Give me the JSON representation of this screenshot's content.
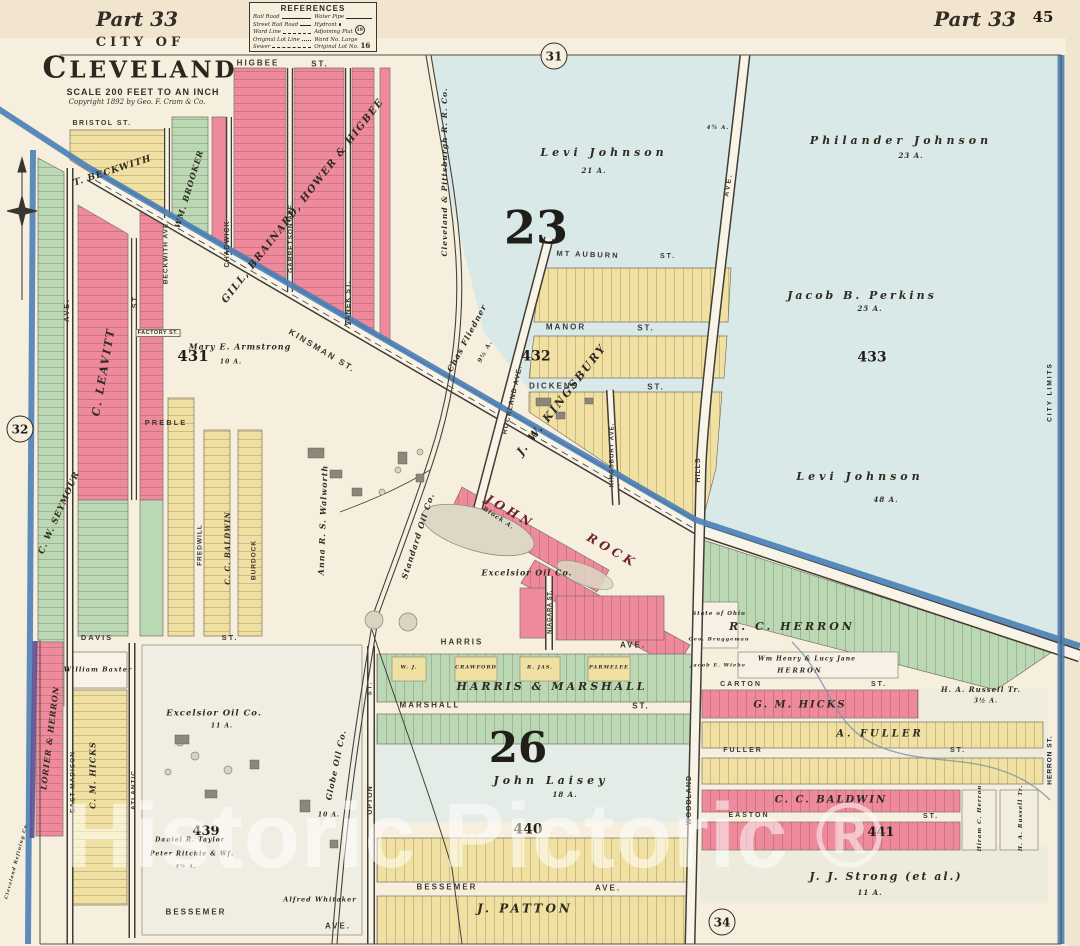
{
  "header": {
    "part_left": "Part 33",
    "city_of": "CITY OF",
    "cleveland": "CLEVELAND",
    "scale": "SCALE 200 FEET TO AN INCH",
    "copyright": "Copyright 1892 by Geo. F. Cram & Co.",
    "part_right": "Part 33",
    "page_number": "45",
    "watermark": "Historic Pictoric ®"
  },
  "references": {
    "title": "REFERENCES",
    "rail_road": "Rail Road",
    "street_rail_road": "Street Rail Road",
    "ward_line": "Ward Line",
    "original_lot_line": "Original Lot Line",
    "sewer": "Sewer",
    "water_pipe": "Water Pipe",
    "hydrant": "Hydrant",
    "adjoining_plat": "Adjoining Plat",
    "adjoining_plat_no": "19",
    "ward_no": "Ward No. Large",
    "original_lot_no": "Original Lot No.",
    "original_lot_no_val": "16"
  },
  "circles": {
    "plate_31": "31",
    "plate_32": "32",
    "plate_34": "34"
  },
  "wards": {
    "ward_23": "23",
    "ward_26": "26"
  },
  "blocks": {
    "b431": "431",
    "b432": "432",
    "b433": "433",
    "b439": "439",
    "b440": "440",
    "b441": "441"
  },
  "streets": {
    "bristol": "BRISTOL ST.",
    "higbee": "HIGBEE",
    "higbee_st": "ST.",
    "beckwith_ave": "BECKWITH AVE.",
    "chadwick": "CHADWICK",
    "garretson": "GARRETSON AVE.",
    "vanek": "VANEK ST.",
    "kinsman": "KINSMAN ST.",
    "factory": "FACTORY ST.",
    "ave_left": "AVE.",
    "st_left": "ST.",
    "preble": "PREBLE",
    "fredwill": "FREDWILL",
    "burdock": "BURDOCK",
    "davis": "DAVIS",
    "davis_st": "ST.",
    "east_madison": "EAST MADISON",
    "atlantic": "ATLANTIC",
    "upton": "UPTON",
    "upton_st": "ST.",
    "mt_auburn": "MT AUBURN",
    "mt_auburn_st": "ST.",
    "manor": "MANOR",
    "manor_st": "ST.",
    "dickens": "DICKENS",
    "dickens_st": "ST.",
    "rockland": "ROCKLAND AVE.",
    "kingsbury": "KINGSBURY AVE.",
    "niagara": "NIAGARA ST.",
    "harris": "HARRIS",
    "harris_ave": "AVE.",
    "marshall": "MARSHALL",
    "marshall_st": "ST.",
    "bessemer_mid": "BESSEMER",
    "bessemer_mid_ave": "AVE.",
    "bessemer_left": "BESSEMER",
    "bessemer_left_ave": "AVE.",
    "carton": "CARTON",
    "carton_st": "ST.",
    "fuller": "FULLER",
    "fuller_st": "ST.",
    "easton": "EASTON",
    "easton_st": "ST.",
    "woodland": "WOODLAND",
    "hills": "HILLS",
    "woodland_ave": "AVE.",
    "herron": "HERRON ST.",
    "city_limits": "CITY LIMITS"
  },
  "owners": {
    "t_beckwith": "T. BECKWITH",
    "wm_brooker": "WM. BROOKER",
    "gill": "GILL, BRAINARD, HOWER & HIGBEE",
    "c_leavitt": "C. LEAVITT",
    "cw_seymour": "C. W. SEYMOUR",
    "cc_baldwin_col": "C. C. BALDWIN",
    "mary_armstrong": "Mary E. Armstrong",
    "mary_acres": "10 A.",
    "levi_johnson_n": "Levi Johnson",
    "levi_n_acres": "21 A.",
    "philander": "Philander Johnson",
    "philander_acres": "23 A.",
    "perkins": "Jacob B. Perkins",
    "perkins_acres": "25 A.",
    "levi_johnson_s": "Levi Johnson",
    "levi_s_acres": "48 A.",
    "small_acres": "4¾ A.",
    "cp_rr": "Cleveland & Pittsburgh R. R. Co.",
    "fliedner": "Chas Fliedner",
    "fliedner_acres": "9½ A.",
    "jw_kingsbury": "J. W. KINGSBURY",
    "john": "JOHN",
    "rock": "ROCK",
    "block_a": "Block A.",
    "walworth": "Anna R. S. Walworth",
    "standard_oil": "Standard Oil Co.",
    "excelsior_mid": "Excelsior Oil Co.",
    "harris_marshall": "HARRIS & MARSHALL",
    "wj": "W. J.",
    "crawford": "CRAWFORD",
    "r_jas": "R. JAS.",
    "parmelee": "PARMELEE",
    "john_laisey": "John Laisey",
    "laisey_acres": "18 A.",
    "j_patton": "J. PATTON",
    "wm_baxter": "William Baxter",
    "cm_hicks": "C. M. HICKS",
    "lorier_herron": "LORIER & HERRON",
    "excelsior_sw": "Excelsior Oil Co.",
    "excelsior_sw_acres": "11 A.",
    "taylor": "Daniel R. Taylor",
    "ritchie": "Peter Ritchie & Wf.",
    "ritchie_acres": "4¾ A.",
    "globe": "Globe Oil Co.",
    "globe_acres": "10 A.",
    "whitaker": "Alfred Whitaker",
    "cleveland_refining": "Cleveland Refining Co.",
    "rc_herron": "R. C. HERRON",
    "state_of_ohio": "State of Ohio",
    "bruggeman": "Geo. Bruggeman",
    "wiebe": "Jacob E. Wiebe",
    "wm_henry": "Wm Henry & Lucy Jane",
    "herron_name": "HERRON",
    "russell_n": "H. A. Russell Tr.",
    "russell_n_acres": "3½ A.",
    "gm_hicks": "G. M. HICKS",
    "a_fuller": "A. FULLER",
    "cc_baldwin_s": "C. C. BALDWIN",
    "hiram": "Hiram C. Herron",
    "russell_col": "H. A. Russell Tr.",
    "jj_strong": "J. J. Strong (et al.)",
    "strong_acres": "11 A."
  }
}
